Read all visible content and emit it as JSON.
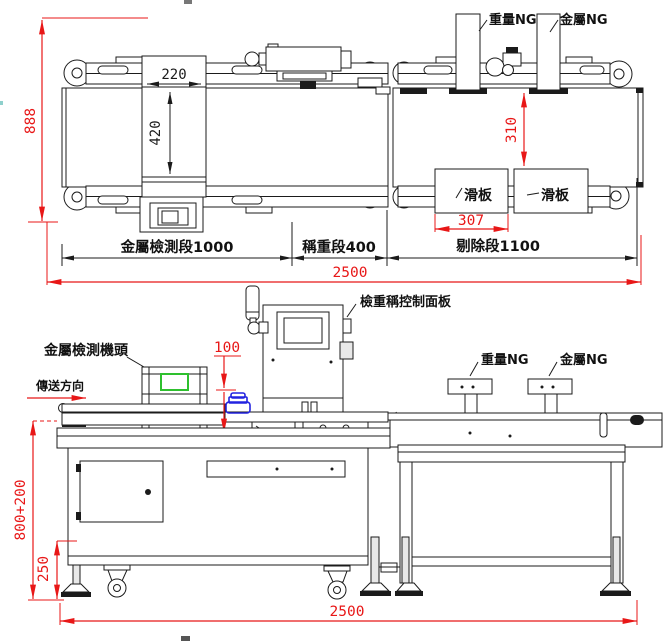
{
  "top_view": {
    "labels": {
      "weight_ng": "重量NG",
      "metal_ng": "金屬NG",
      "slide_plate": "滑板"
    },
    "dims": {
      "overall_width": "888",
      "detector_width": "220",
      "detector_length": "420",
      "belt_width": "310",
      "slide_plate_width": "307",
      "metal_detect_section": "金屬檢測段1000",
      "weighing_section": "稱重段400",
      "reject_section": "剔除段1100",
      "total_length": "2500"
    }
  },
  "side_view": {
    "labels": {
      "metal_detector_head": "金屬檢測機頭",
      "checkweigher_panel": "檢重稱控制面板",
      "convey_direction": "傳送方向",
      "weight_ng": "重量NG",
      "metal_ng": "金屬NG"
    },
    "dims": {
      "pass_height": "100",
      "work_height": "800+200",
      "foot_height": "250",
      "total_length": "2500"
    }
  },
  "colors": {
    "line": "#1b1b1b",
    "dimension_red": "#e81717",
    "screen_green": "#2ec02e",
    "product_blue": "#2323e0"
  }
}
